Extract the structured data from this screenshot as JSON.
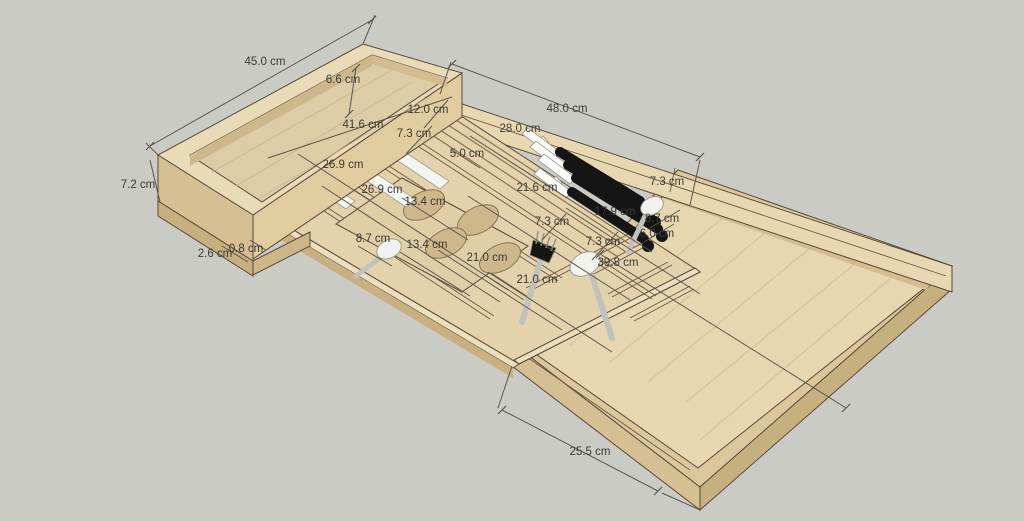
{
  "scene": {
    "type": "3d-model-render",
    "subject": "Expandable wooden cutlery drawer organizer with knife block, egg-cup holes and cutlery, annotated with measurements",
    "unit": "cm"
  },
  "colors": {
    "background": "#cbcbc6",
    "wood_rim": "#e9dbb8",
    "wood_floor": "#ddcda6",
    "wood_floor_right": "#e6d7b1",
    "wood_front_face": "#d5bf93",
    "wood_shadow_face": "#c7b080",
    "outline": "#57493a",
    "dimension_line": "#5a564e",
    "dimension_text": "#3c3a35",
    "knife_handle": "#151515",
    "cutlery_metal": "#f2f2ef"
  },
  "dimensions": [
    {
      "text": "45.0 cm"
    },
    {
      "text": "6.6 cm"
    },
    {
      "text": "48.0 cm"
    },
    {
      "text": "41.6 cm"
    },
    {
      "text": "12.0 cm"
    },
    {
      "text": "7.3 cm"
    },
    {
      "text": "28.0 cm"
    },
    {
      "text": "26.9 cm"
    },
    {
      "text": "26.9 cm"
    },
    {
      "text": "5.0 cm"
    },
    {
      "text": "21.6 cm"
    },
    {
      "text": "7.3 cm"
    },
    {
      "text": "17.9 cm"
    },
    {
      "text": "8.7 cm"
    },
    {
      "text": "6.0 cm"
    },
    {
      "text": "7.3 cm"
    },
    {
      "text": "7.3 cm"
    },
    {
      "text": "13.4 cm"
    },
    {
      "text": "13.4 cm"
    },
    {
      "text": "8.7 cm"
    },
    {
      "text": "21.0 cm"
    },
    {
      "text": "21.0 cm"
    },
    {
      "text": "39.8 cm"
    },
    {
      "text": "2.6 cm"
    },
    {
      "text": "0.8 cm"
    },
    {
      "text": "7.2 cm"
    },
    {
      "text": "25.5 cm"
    }
  ]
}
